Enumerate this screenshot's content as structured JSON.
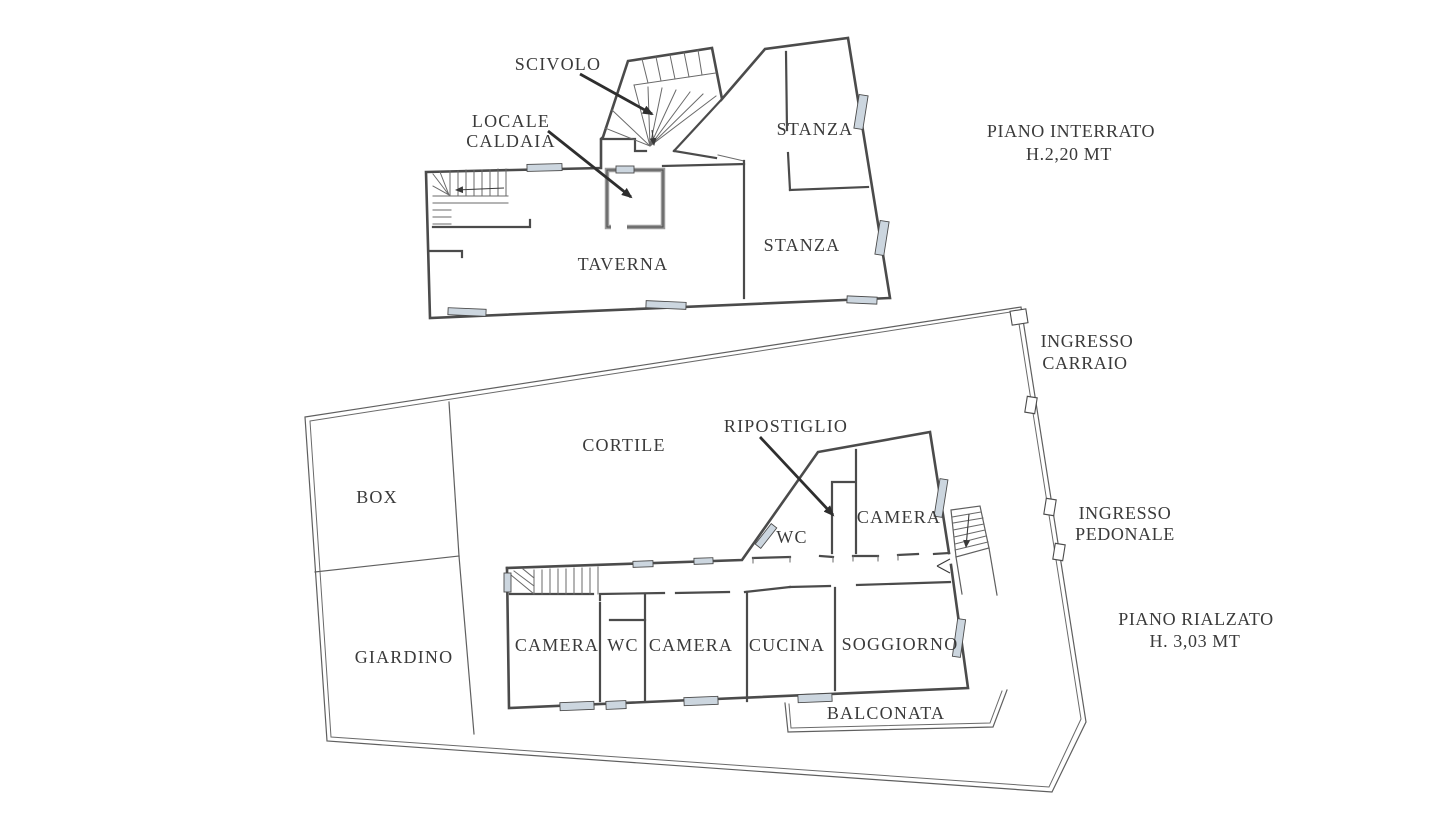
{
  "colors": {
    "wall": "#4b4b4b",
    "thin_line": "#6a6a6a",
    "window_fill": "#ccd6df",
    "text": "#3a3a3a",
    "background": "#ffffff"
  },
  "interrato": {
    "title1": "PIANO INTERRATO",
    "title2": "H.2,20 MT",
    "scivolo": "SCIVOLO",
    "locale1": "LOCALE",
    "locale2": "CALDAIA",
    "stanza_top": "STANZA",
    "stanza_bottom": "STANZA",
    "taverna": "TAVERNA"
  },
  "rialzato": {
    "title1": "PIANO RIALZATO",
    "title2": "H. 3,03 MT",
    "ingresso_carraio1": "INGRESSO",
    "ingresso_carraio2": "CARRAIO",
    "ingresso_pedonale1": "INGRESSO",
    "ingresso_pedonale2": "PEDONALE",
    "cortile": "CORTILE",
    "box": "BOX",
    "giardino": "GIARDINO",
    "ripostiglio": "RIPOSTIGLIO",
    "camera_top": "CAMERA",
    "wc_top": "WC",
    "camera_left": "CAMERA",
    "wc_bottom": "WC",
    "camera_mid": "CAMERA",
    "cucina": "CUCINA",
    "soggiorno": "SOGGIORNO",
    "balconata": "BALCONATA"
  }
}
